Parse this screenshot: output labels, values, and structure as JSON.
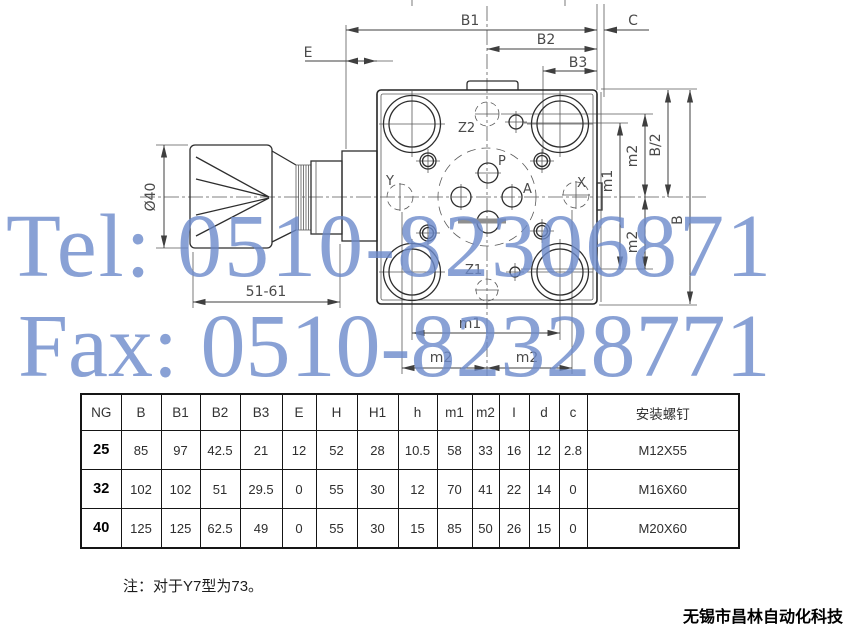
{
  "watermark": {
    "tel": "Tel: 0510-82306871",
    "fax": "Fax: 0510-82328771",
    "color": "#6c8aca"
  },
  "drawing": {
    "dims": {
      "b1": "B1",
      "b2": "B2",
      "b3": "B3",
      "c": "C",
      "e": "E",
      "knob_diameter": "Ø40",
      "adjust_length": "51-61",
      "m1": "m1",
      "m2": "m2",
      "b_half": "B/2",
      "b": "B"
    },
    "ports": {
      "p": "P",
      "a": "A",
      "x": "X",
      "y": "Y",
      "z1": "Z1",
      "z2": "Z2"
    }
  },
  "table": {
    "columns": [
      "NG",
      "B",
      "B1",
      "B2",
      "B3",
      "E",
      "H",
      "H1",
      "h",
      "m1",
      "m2",
      "I",
      "d",
      "c",
      "安装螺钉"
    ],
    "rows": [
      [
        "25",
        "85",
        "97",
        "42.5",
        "21",
        "12",
        "52",
        "28",
        "10.5",
        "58",
        "33",
        "16",
        "12",
        "2.8",
        "M12X55"
      ],
      [
        "32",
        "102",
        "102",
        "51",
        "29.5",
        "0",
        "55",
        "30",
        "12",
        "70",
        "41",
        "22",
        "14",
        "0",
        "M16X60"
      ],
      [
        "40",
        "125",
        "125",
        "62.5",
        "49",
        "0",
        "55",
        "30",
        "15",
        "85",
        "50",
        "26",
        "15",
        "0",
        "M20X60"
      ]
    ]
  },
  "note": "注：对于Y7型为73。",
  "footer": {
    "company": "无锡市昌林自动化科技"
  }
}
